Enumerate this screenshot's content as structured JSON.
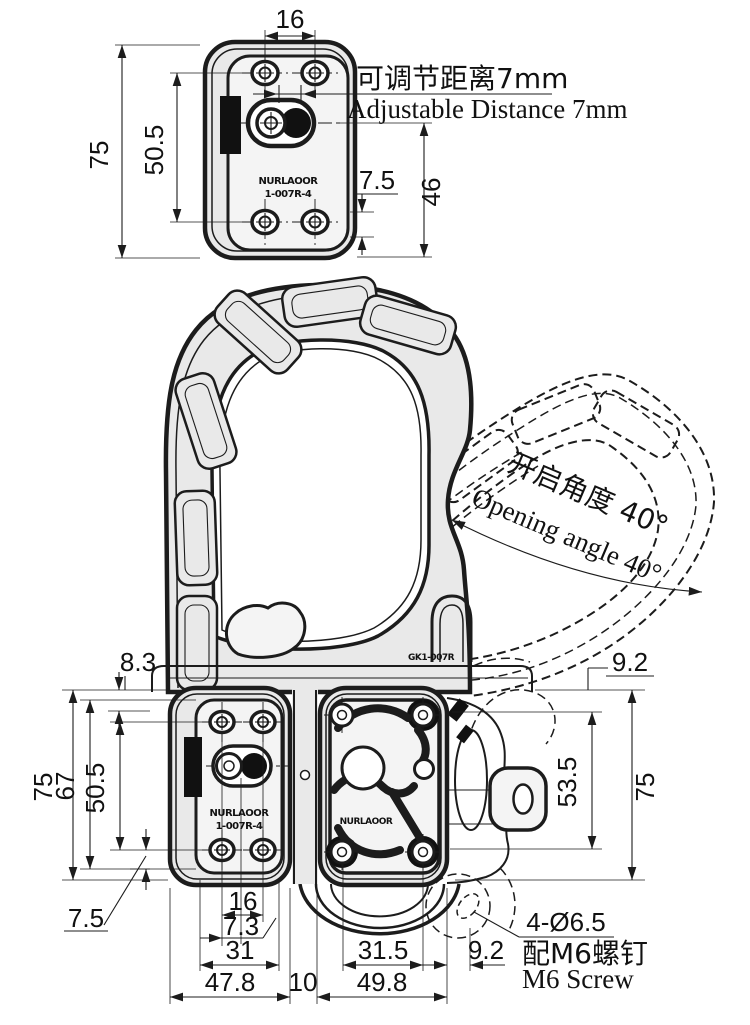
{
  "colors": {
    "line": "#1c1c1c",
    "plate_fill": "#e9e9e9",
    "panel_fill": "#f4f4f4",
    "accent_black": "#111111",
    "background": "#ffffff"
  },
  "top_view": {
    "dim_top_width": "16",
    "dim_left_height": "75",
    "dim_left_hole_spacing": "50.5",
    "dim_right_offset": "7.5",
    "dim_right_height": "46",
    "note_cn": "可调节距离7mm",
    "note_en": "Adjustable Distance  7mm",
    "marking_line1": "NURLAOOR",
    "marking_line2": "1-007R-4"
  },
  "open_view": {
    "note_cn": "开启角度 40°",
    "note_en": "Opening angle 40°",
    "marking": "GK1-007R"
  },
  "front_view": {
    "dim_left_offset": "8.3",
    "dim_left_height": "75",
    "dim_left_inner_height": "67",
    "dim_left_hole_spacing": "50.5",
    "dim_left_bottom_offset": "7.5",
    "dim_right_offset": "9.2",
    "dim_right_hole_height": "53.5",
    "dim_right_height": "75",
    "dim_bottom_hole_span": "16",
    "dim_bottom_knob_offset": "7.3",
    "dim_bottom_panel_width": "31",
    "dim_bottom_left_width": "47.8",
    "dim_bottom_gap": "10",
    "dim_bottom_right_width": "49.8",
    "dim_bottom_right_hole_span": "31.5",
    "dim_bottom_edge_offset": "9.2",
    "note_hole_spec": "4-Ø6.5",
    "note_screw_cn": "配M6螺钉",
    "note_screw_en": "M6 Screw",
    "marking_left_line1": "NURLAOOR",
    "marking_left_line2": "1-007R-4",
    "marking_right": "NURLAOOR"
  }
}
